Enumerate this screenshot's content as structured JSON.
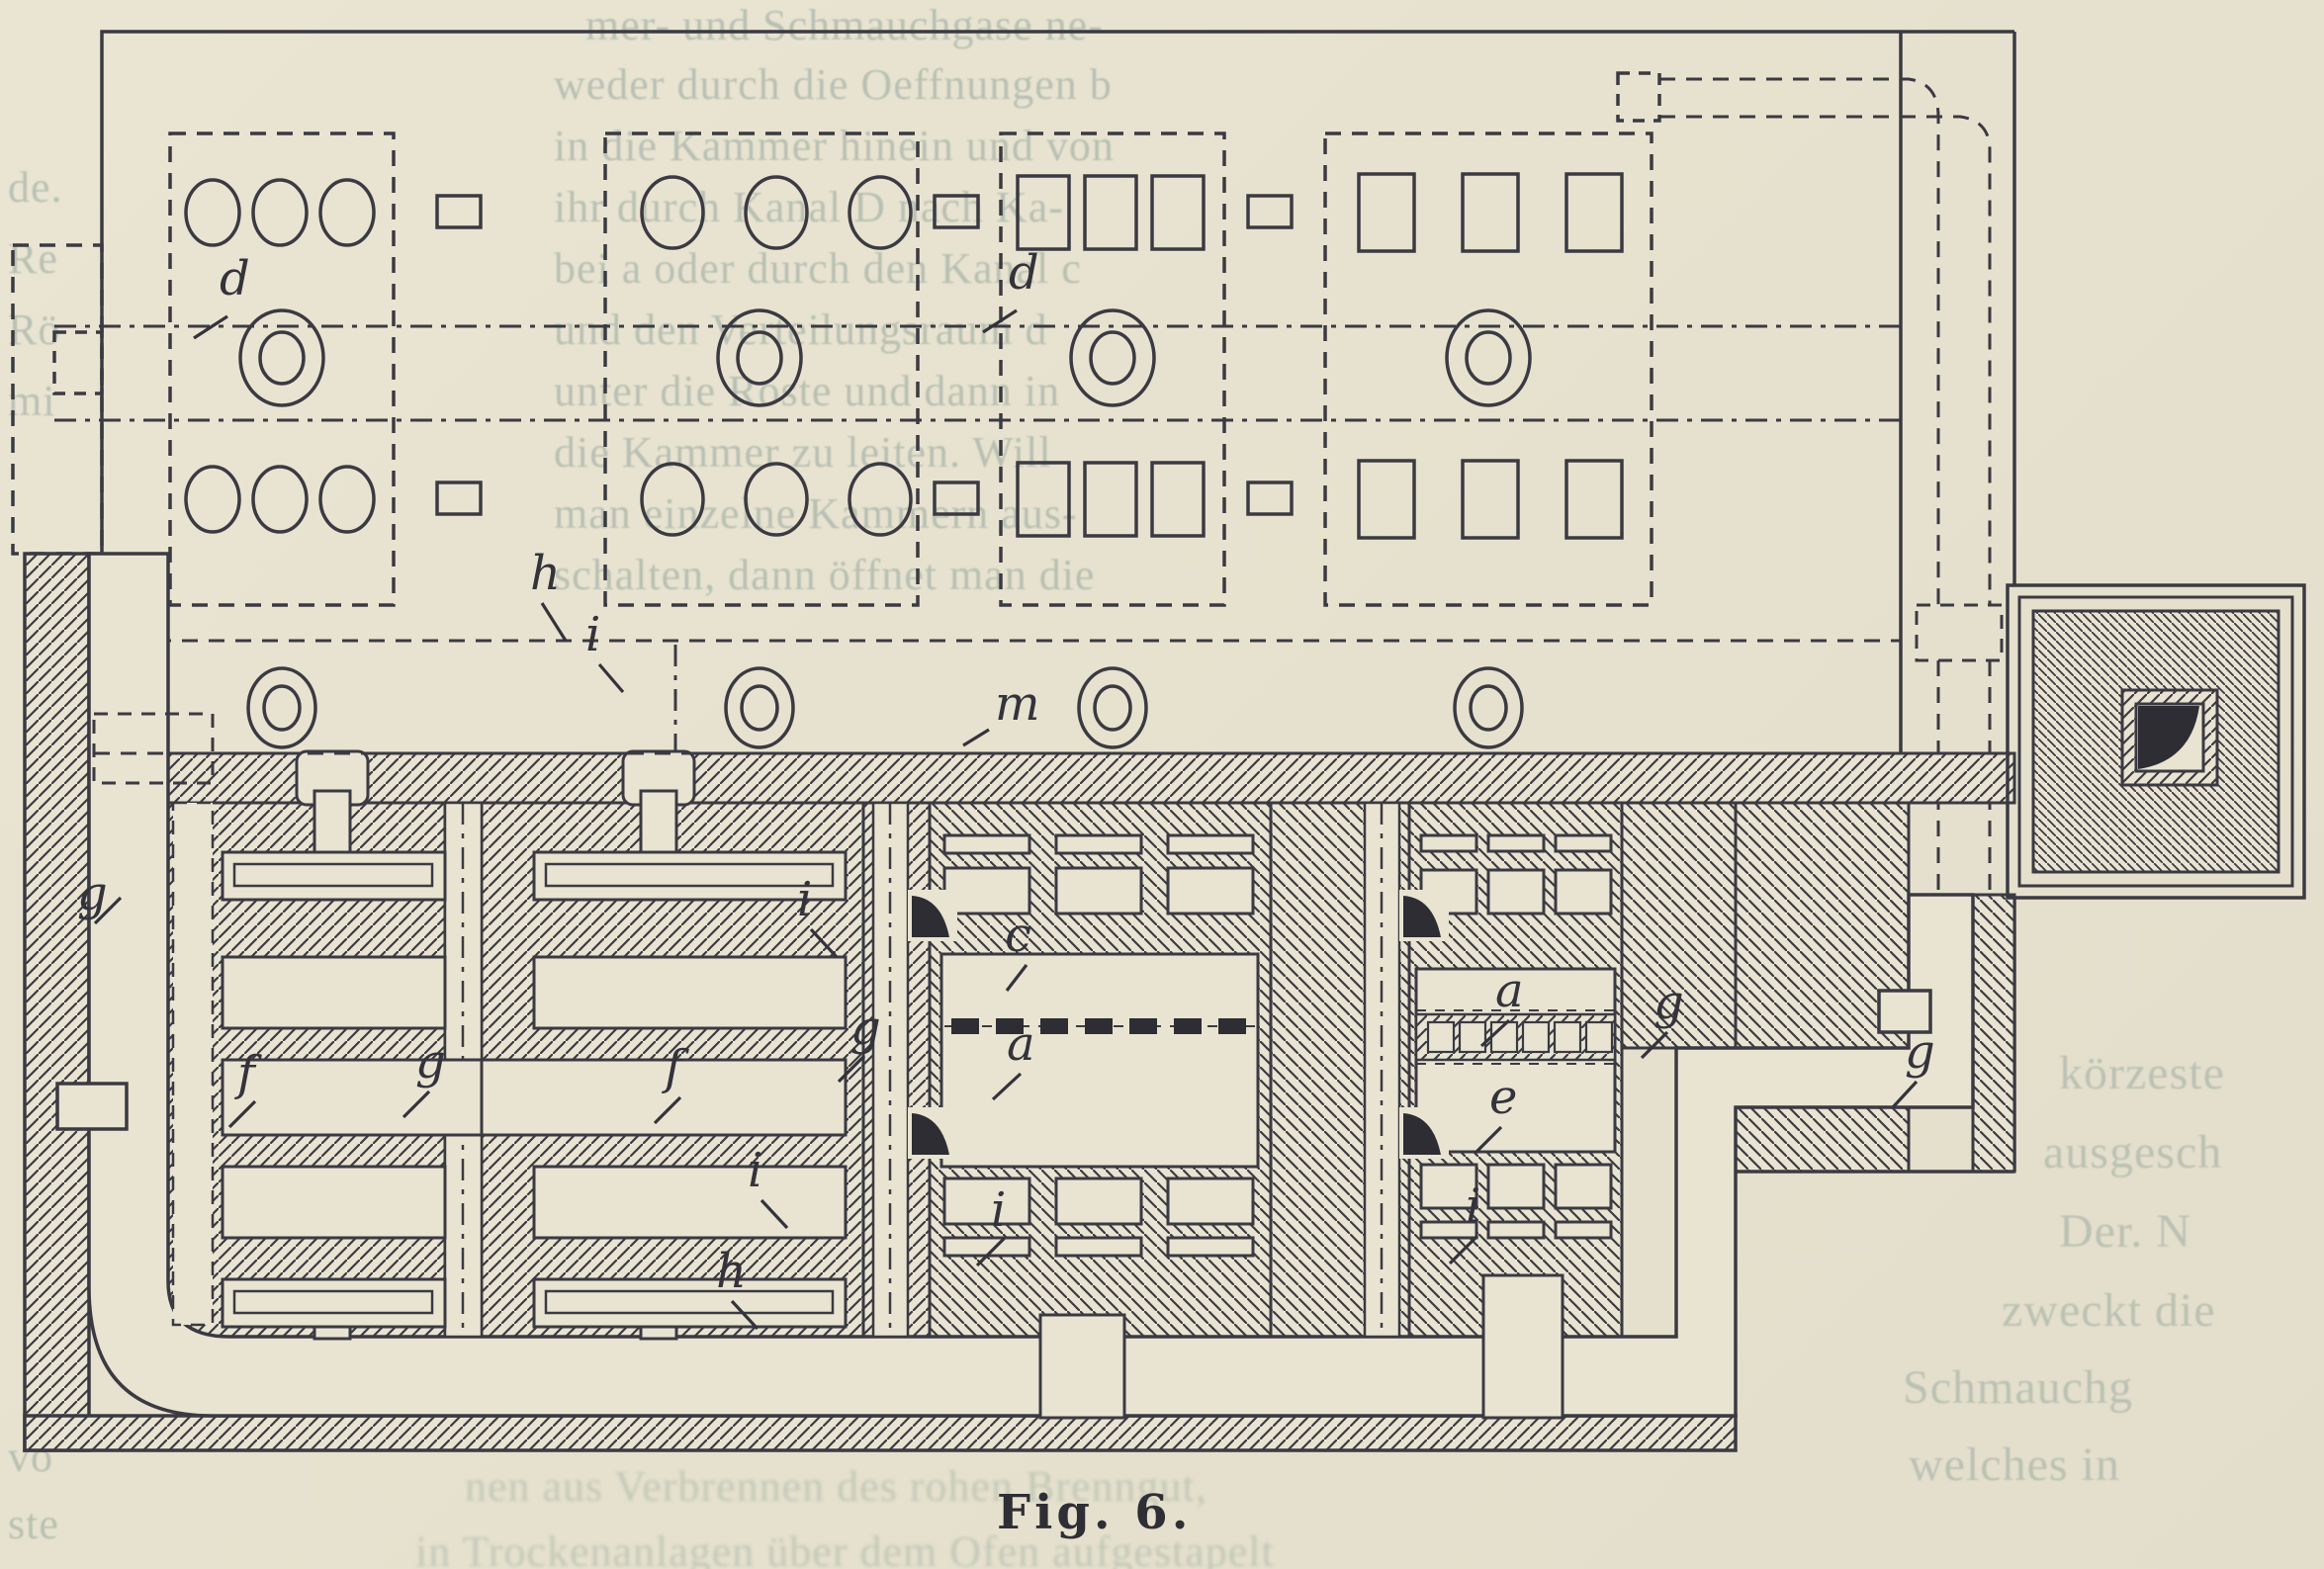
{
  "page": {
    "background": "#e7e2cf",
    "ink": "#3b3a42",
    "paper": "#e9e4d2",
    "faint_text_color": "#93a49b",
    "caption_color": "#2f2e35"
  },
  "figure": {
    "caption": "Fig. 6.",
    "type": "kiln floor plan, hatched section drawing"
  },
  "labels": [
    {
      "text": "d"
    },
    {
      "text": "d"
    },
    {
      "text": "m"
    },
    {
      "text": "h"
    },
    {
      "text": "i"
    },
    {
      "text": "g"
    },
    {
      "text": "f"
    },
    {
      "text": "g"
    },
    {
      "text": "f"
    },
    {
      "text": "i"
    },
    {
      "text": "i"
    },
    {
      "text": "h"
    },
    {
      "text": "g"
    },
    {
      "text": "c"
    },
    {
      "text": "a"
    },
    {
      "text": "i"
    },
    {
      "text": "a"
    },
    {
      "text": "e"
    },
    {
      "text": "i"
    },
    {
      "text": "g"
    },
    {
      "text": "g"
    }
  ],
  "bleed_text": {
    "top_column": [
      {
        "text": "mer- und Schmauchgase ne-"
      },
      {
        "text": "weder durch die Oeffnungen b"
      },
      {
        "text": "in die Kammer hinein und von"
      },
      {
        "text": "ihr durch Kanal D nach Ka-"
      },
      {
        "text": "bei a oder durch den Kanal c"
      },
      {
        "text": "und den Verteilungsraum d"
      },
      {
        "text": "unter die Roste und dann in"
      },
      {
        "text": "die Kammer zu leiten. Will"
      },
      {
        "text": "man einzelne Kammern aus-"
      },
      {
        "text": "schalten, dann öffnet man die"
      }
    ],
    "right_column": [
      {
        "text": "körzeste"
      },
      {
        "text": "ausgesch"
      },
      {
        "text": "Der. N"
      },
      {
        "text": "zweckt die"
      },
      {
        "text": "Schmauchg"
      },
      {
        "text": "welches in"
      }
    ],
    "left_margin": [
      {
        "text": "de."
      },
      {
        "text": "Re"
      },
      {
        "text": "Rö"
      },
      {
        "text": "mi"
      },
      {
        "text": "vo"
      },
      {
        "text": "ste"
      }
    ],
    "below_figure": [
      {
        "text": "nen aus Verbrennen des rohen Brenngut,"
      },
      {
        "text": "in Trockenanlagen über dem Ofen aufgestapelt"
      }
    ]
  }
}
